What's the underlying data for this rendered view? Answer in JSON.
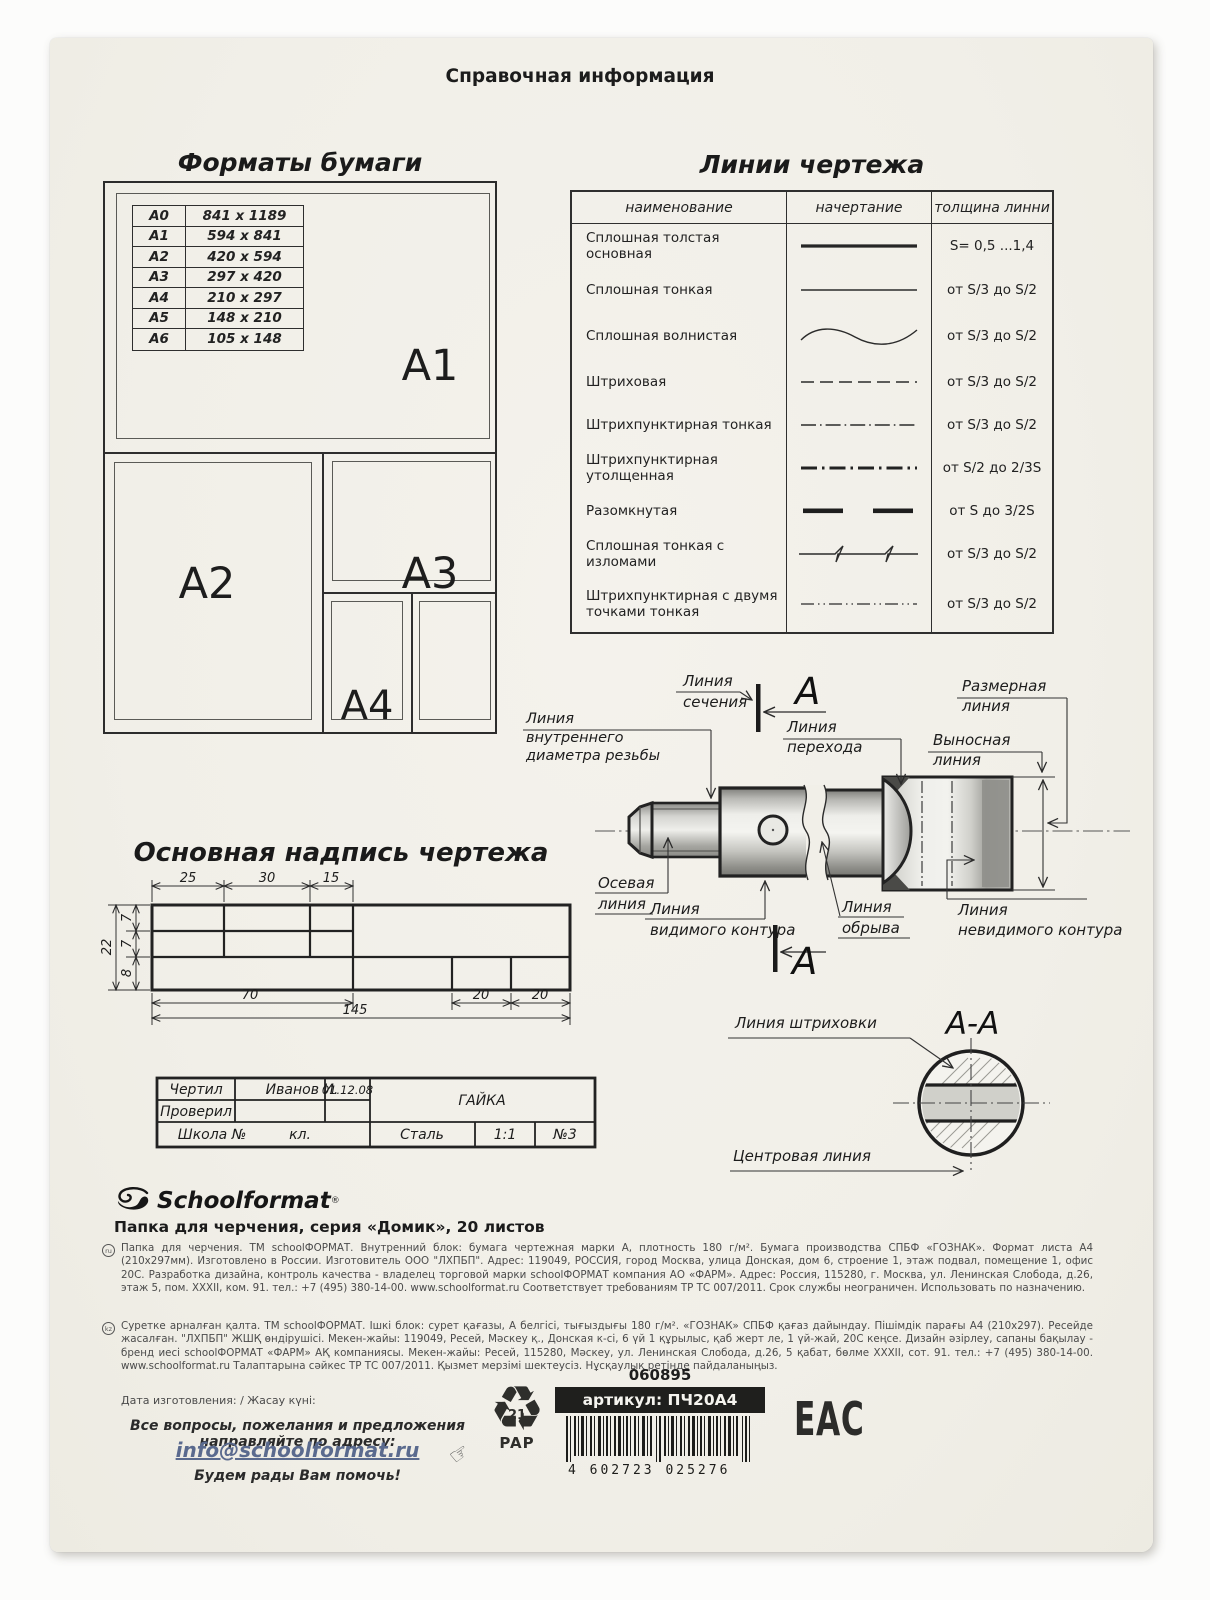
{
  "page": {
    "title": "Справочная информация"
  },
  "formats": {
    "heading": "Форматы бумаги",
    "rows": [
      [
        "A0",
        "841 x 1189"
      ],
      [
        "A1",
        "594 x 841"
      ],
      [
        "A2",
        "420 x 594"
      ],
      [
        "A3",
        "297 x 420"
      ],
      [
        "A4",
        "210 x 297"
      ],
      [
        "A5",
        "148 x 210"
      ],
      [
        "A6",
        "105 x 148"
      ]
    ],
    "sheet_labels": {
      "a1": "A1",
      "a2": "A2",
      "a3": "A3",
      "a4": "A4"
    }
  },
  "lines": {
    "heading": "Линии чертежа",
    "columns": [
      "наименование",
      "начертание",
      "толщина линни"
    ],
    "rows": [
      {
        "name": "Сплошная толстая основная",
        "th": "S= 0,5 ...1,4"
      },
      {
        "name": "Сплошная тонкая",
        "th": "от S/3 до S/2"
      },
      {
        "name": "Сплошная волнистая",
        "th": "от S/3 до S/2"
      },
      {
        "name": "Штриховая",
        "th": "от S/3 до S/2"
      },
      {
        "name": "Штрихпунктирная тонкая",
        "th": "от S/3 до S/2"
      },
      {
        "name": "Штрихпунктирная утолщенная",
        "th": "от S/2 до 2/3S"
      },
      {
        "name": "Разомкнутая",
        "th": "от S до 3/2S"
      },
      {
        "name": "Сплошная тонкая с изломами",
        "th": "от S/3 до S/2"
      },
      {
        "name": "Штрихпунктирная с двумя точками тонкая",
        "th": "от S/3 до S/2"
      }
    ]
  },
  "drawing": {
    "section_letter": "A",
    "section_title": "A-A",
    "labels": {
      "section": [
        "Линия",
        "сечения"
      ],
      "dimension": [
        "Размерная",
        "линия"
      ],
      "extension": [
        "Выносная",
        "линия"
      ],
      "transition": [
        "Линия",
        "перехода"
      ],
      "inner_diameter": [
        "Линия",
        "внутреннего",
        "диаметра резьбы"
      ],
      "axis": [
        "Осевая",
        "линия"
      ],
      "visible": [
        "Линия",
        "видимого контура"
      ],
      "break": [
        "Линия",
        "обрыва"
      ],
      "hidden": [
        "Линия",
        "невидимого контура"
      ],
      "hatch": "Линия штриховки",
      "center": "Центровая линия"
    }
  },
  "titleblock": {
    "heading": "Основная надпись чертежа",
    "dims": {
      "top": [
        "25",
        "30",
        "15"
      ],
      "total_height": "22",
      "heights": [
        "7",
        "7",
        "8"
      ],
      "bottom": [
        "70",
        "20",
        "20"
      ],
      "total_width": "145"
    },
    "cells": {
      "drew": "Чертил",
      "drew_name": "Иванов И.",
      "date": "01.12.08",
      "checked": "Проверил",
      "part": "ГАЙКА",
      "school": "Школа №",
      "class": "кл.",
      "material": "Сталь",
      "scale": "1:1",
      "number": "№3"
    }
  },
  "footer": {
    "brand": "Schoolformat",
    "reg": "®",
    "product": "Папка для черчения, серия «Домик», 20 листов",
    "ru_mark": "ru",
    "kz_mark": "kz",
    "ru_text": "Папка для черчения. ТМ schoolФОРМАТ. Внутренний блок: бумага чертежная марки А, плотность 180 г/м². Бумага производства СПБФ «ГОЗНАК». Формат листа А4 (210х297мм). Изготовлено в России. Изготовитель ООО \"ЛХПБП\". Адрес: 119049, РОССИЯ, город Москва, улица Донская, дом 6, строение 1, этаж подвал, помещение 1, офис 20С. Разработка дизайна, контроль качества - владелец торговой марки schoolФОРМАТ компания АО «ФАРМ». Адрес: Россия, 115280, г. Москва, ул. Ленинская Слобода, д.26, этаж 5, пом. XXXII, ком. 91. тел.: +7 (495) 380-14-00. www.schoolformat.ru Соответствует требованиям ТР ТС 007/2011. Срок службы неограничен. Использовать по назначению.",
    "kz_text": "Суретке арналған қалта. ТМ schoolФОРМАТ. Ішкі блок: сурет қағазы, А белгісі, тығыздығы 180 г/м². «ГОЗНАК» СПБФ қағаз дайындау. Пішімдік парағы А4 (210х297). Ресейде жасалған. \"ЛХПБП\" ЖШҚ өндірушісі. Мекен-жайы: 119049, Ресей, Мәскеу қ., Донская к-сі, 6 үй 1 құрылыс, қаб жерт ле, 1 үй-жай, 20С кеңсе. Дизайн әзірлеу, сапаны бақылау - бренд иесі schoolФОРМАТ «ФАРМ» АҚ компаниясы. Мекен-жайы: Ресей, 115280, Мәскеу, ул. Ленинская Слобода, д.26, 5 қабат, бөлме XXXII, сот. 91. тел.: +7 (495) 380-14-00. www.schoolformat.ru Талаптарына сәйкес ТР ТС 007/2011. Қызмет мерзімі шектеусіз. Нұсқаулық ретінде пайдаланыңыз.",
    "date_label": "Дата изготовления: / Жасау күні:",
    "contact_line": "Все вопросы, пожелания и предложения направляйте по адресу:",
    "email": "info@schoolformat.ru",
    "thanks": "Будем рады Вам помочь!",
    "code": "060895",
    "sku": "артикул: ПЧ20А4",
    "barcode_digits": "4 602723 025276",
    "recycle_number": "21",
    "recycle_material": "PAP",
    "eac": "ЕАС"
  },
  "colors": {
    "card": "#f1efe8",
    "ink": "#222222",
    "link": "#5a6a8e"
  }
}
